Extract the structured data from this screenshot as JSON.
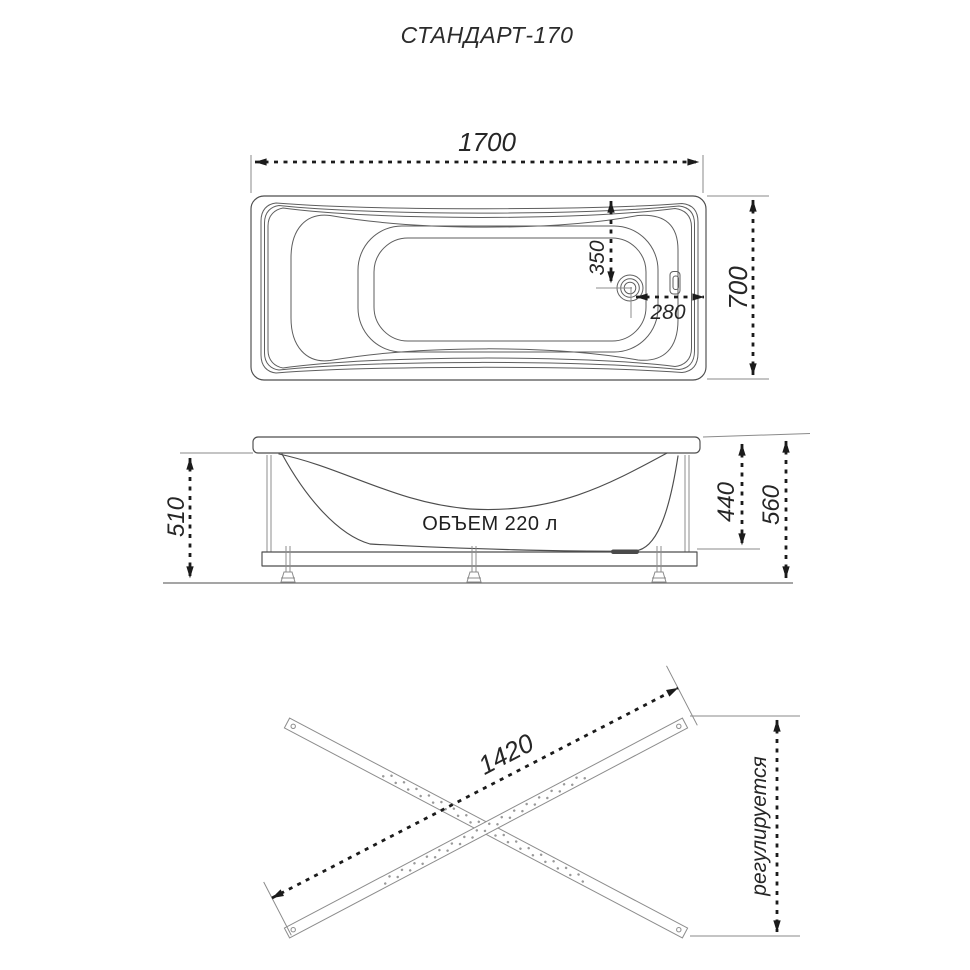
{
  "title": "СТАНДАРТ-170",
  "colors": {
    "drawing_line": "#4d4d4d",
    "dimension_line": "#1b1b1b",
    "extension_line": "#8c8c8c",
    "text": "#262626",
    "background": "#ffffff"
  },
  "top_view": {
    "length": "1700",
    "width": "700",
    "drain_from_edge": "350",
    "drain_from_end": "280"
  },
  "side_view": {
    "volume": "ОБЪЕМ 220 л",
    "rim_clearance": "510",
    "depth_to_frame": "440",
    "overall_height": "560"
  },
  "frame_view": {
    "rail_length": "1420",
    "height_note": "регулируется"
  }
}
